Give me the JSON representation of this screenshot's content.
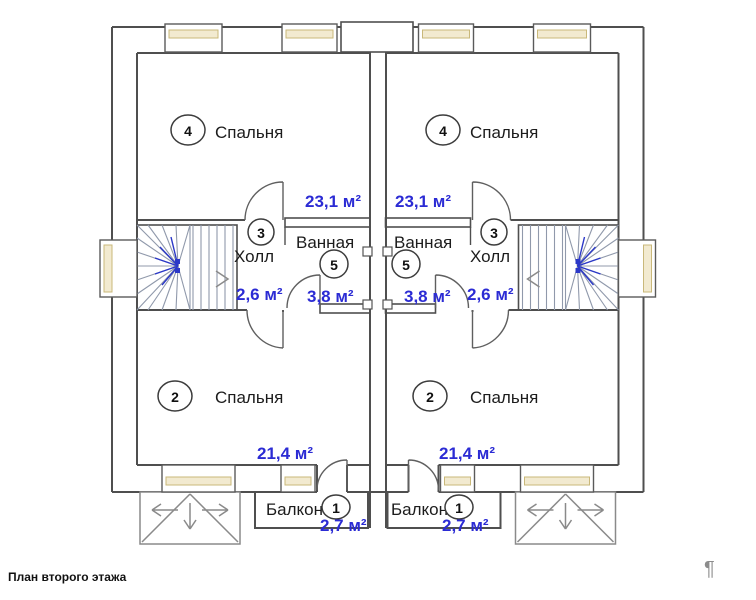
{
  "caption": "План второго этажа",
  "watermark": "¶",
  "rooms": {
    "bedroom_top": {
      "number": "4",
      "name": "Спальня",
      "area": "23,1 м²"
    },
    "hall": {
      "number": "3",
      "name": "Холл",
      "area": "2,6 м²"
    },
    "bathroom": {
      "number": "5",
      "name": "Ванная",
      "area": "3,8 м²"
    },
    "bedroom_bottom": {
      "number": "2",
      "name": "Спальня",
      "area": "21,4 м²"
    },
    "balcony": {
      "number": "1",
      "name": "Балкон",
      "area": "2,7 м²"
    }
  },
  "colors": {
    "area_text": "#2b2bd4",
    "walls": "#4f4f4f",
    "window_fill": "#f2ead0",
    "window_line": "#c9b87a",
    "stair_lines": "#9099ab",
    "stair_hub": "#2b38c8"
  }
}
